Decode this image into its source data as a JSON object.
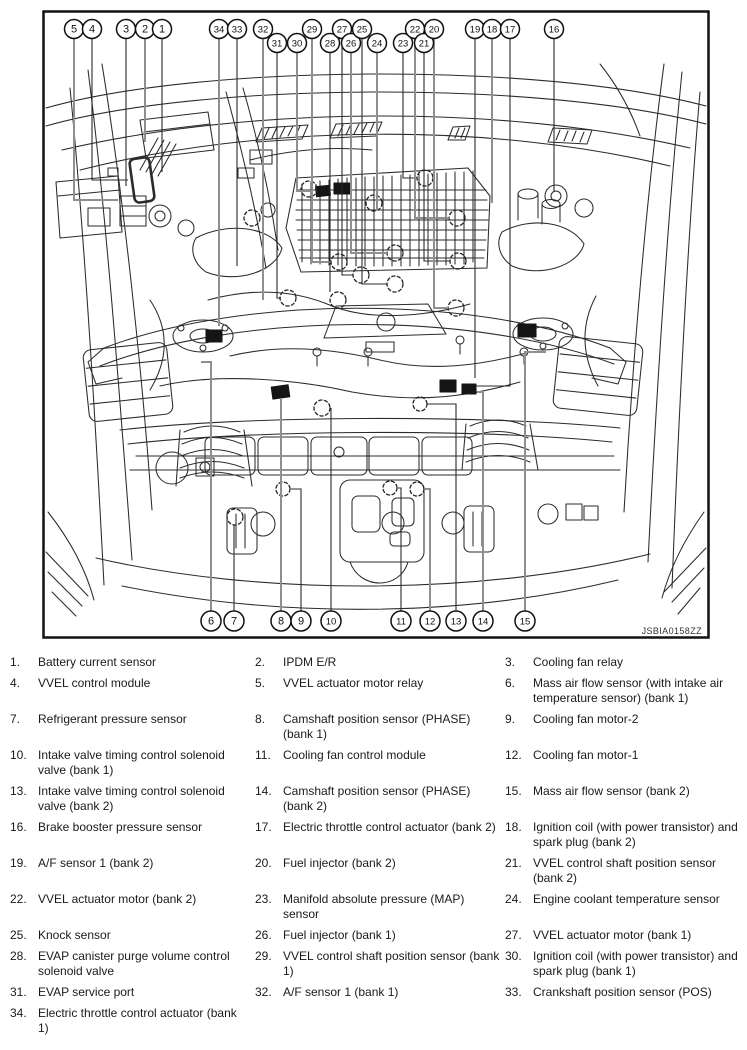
{
  "figure": {
    "code": "JSBIA0158ZZ",
    "callouts": [
      {
        "n": "5",
        "x": 74,
        "y": 29,
        "ey": 200,
        "jx": 118,
        "style": "gray"
      },
      {
        "n": "4",
        "x": 92,
        "y": 29,
        "ey": 180,
        "jx": 128,
        "style": "black"
      },
      {
        "n": "3",
        "x": 126,
        "y": 29,
        "ey": 186,
        "style": "black"
      },
      {
        "n": "2",
        "x": 145,
        "y": 29,
        "ey": 142,
        "style": "gray"
      },
      {
        "n": "1",
        "x": 162,
        "y": 29,
        "ey": 172,
        "style": "black"
      },
      {
        "n": "34",
        "x": 219,
        "y": 29,
        "ey": 326,
        "style": "gray"
      },
      {
        "n": "33",
        "x": 237,
        "y": 29,
        "ey": 266,
        "style": "black"
      },
      {
        "n": "32",
        "x": 263,
        "y": 29,
        "ey": 300,
        "style": "gray"
      },
      {
        "n": "31",
        "x": 277,
        "y": 43,
        "ey": 298,
        "jx": 281,
        "style": "black"
      },
      {
        "n": "30",
        "x": 297,
        "y": 43,
        "ey": 191,
        "jx": 312,
        "style": "gray"
      },
      {
        "n": "29",
        "x": 312,
        "y": 29,
        "ey": 262,
        "jx": 331,
        "style": "gray"
      },
      {
        "n": "28",
        "x": 330,
        "y": 43,
        "ey": 292,
        "style": "black"
      },
      {
        "n": "27",
        "x": 342,
        "y": 29,
        "ey": 275,
        "jx": 353,
        "style": "black"
      },
      {
        "n": "26",
        "x": 351,
        "y": 43,
        "ey": 253,
        "jx": 387,
        "style": "gray"
      },
      {
        "n": "25",
        "x": 362,
        "y": 29,
        "ey": 284,
        "jx": 387,
        "style": "black"
      },
      {
        "n": "24",
        "x": 377,
        "y": 43,
        "ey": 211,
        "style": "gray"
      },
      {
        "n": "23",
        "x": 403,
        "y": 43,
        "ey": 178,
        "jx": 417,
        "style": "black"
      },
      {
        "n": "22",
        "x": 415,
        "y": 29,
        "ey": 218,
        "jx": 449,
        "style": "gray"
      },
      {
        "n": "21",
        "x": 424,
        "y": 43,
        "ey": 261,
        "jx": 450,
        "style": "black"
      },
      {
        "n": "20",
        "x": 434,
        "y": 29,
        "ey": 308,
        "jx": 448,
        "style": "gray"
      },
      {
        "n": "19",
        "x": 475,
        "y": 29,
        "ey": 378,
        "style": "black"
      },
      {
        "n": "18",
        "x": 492,
        "y": 29,
        "ey": 203,
        "style": "gray"
      },
      {
        "n": "17",
        "x": 510,
        "y": 29,
        "ey": 386,
        "jx": 476,
        "style": "black"
      },
      {
        "n": "16",
        "x": 554,
        "y": 29,
        "ey": 192,
        "style": "black"
      },
      {
        "n": "6",
        "x": 211,
        "y": 621,
        "dir": "up",
        "ey": 362,
        "jx": 201,
        "style": "gray"
      },
      {
        "n": "7",
        "x": 234,
        "y": 621,
        "dir": "up",
        "ey": 525,
        "style": "black"
      },
      {
        "n": "8",
        "x": 281,
        "y": 621,
        "dir": "up",
        "ey": 398,
        "style": "gray"
      },
      {
        "n": "9",
        "x": 301,
        "y": 621,
        "dir": "up",
        "ey": 489,
        "jx": 291,
        "style": "black"
      },
      {
        "n": "10",
        "x": 331,
        "y": 621,
        "dir": "up",
        "ey": 408,
        "style": "black"
      },
      {
        "n": "11",
        "x": 401,
        "y": 621,
        "dir": "up",
        "ey": 488,
        "jx": 398,
        "style": "black"
      },
      {
        "n": "12",
        "x": 430,
        "y": 621,
        "dir": "up",
        "ey": 489,
        "jx": 425,
        "style": "gray"
      },
      {
        "n": "13",
        "x": 456,
        "y": 621,
        "dir": "up",
        "ey": 404,
        "jx": 427,
        "style": "black"
      },
      {
        "n": "14",
        "x": 483,
        "y": 621,
        "dir": "up",
        "ey": 392,
        "jx": 478,
        "style": "gray"
      },
      {
        "n": "15",
        "x": 525,
        "y": 621,
        "dir": "up",
        "ey": 352,
        "jx": 546,
        "style": "gray"
      }
    ]
  },
  "legend": {
    "items": [
      {
        "num": "1.",
        "label": "Battery current sensor"
      },
      {
        "num": "2.",
        "label": "IPDM E/R"
      },
      {
        "num": "3.",
        "label": "Cooling fan relay"
      },
      {
        "num": "4.",
        "label": "VVEL control module"
      },
      {
        "num": "5.",
        "label": "VVEL actuator motor relay"
      },
      {
        "num": "6.",
        "label": "Mass air flow sensor (with intake air temperature sensor) (bank 1)"
      },
      {
        "num": "7.",
        "label": "Refrigerant pressure sensor"
      },
      {
        "num": "8.",
        "label": "Camshaft position sensor (PHASE) (bank 1)"
      },
      {
        "num": "9.",
        "label": "Cooling fan motor-2"
      },
      {
        "num": "10.",
        "label": "Intake valve timing control solenoid valve (bank 1)"
      },
      {
        "num": "11.",
        "label": "Cooling fan control module"
      },
      {
        "num": "12.",
        "label": "Cooling fan motor-1"
      },
      {
        "num": "13.",
        "label": "Intake valve timing control solenoid valve (bank 2)"
      },
      {
        "num": "14.",
        "label": "Camshaft position sensor (PHASE) (bank 2)"
      },
      {
        "num": "15.",
        "label": "Mass air flow sensor (bank 2)"
      },
      {
        "num": "16.",
        "label": "Brake booster pressure sensor"
      },
      {
        "num": "17.",
        "label": "Electric throttle control actuator (bank 2)"
      },
      {
        "num": "18.",
        "label": "Ignition coil (with power transistor) and spark plug (bank 2)"
      },
      {
        "num": "19.",
        "label": "A/F sensor 1 (bank 2)"
      },
      {
        "num": "20.",
        "label": "Fuel injector (bank 2)"
      },
      {
        "num": "21.",
        "label": "VVEL control shaft position sensor (bank 2)"
      },
      {
        "num": "22.",
        "label": "VVEL actuator motor (bank 2)"
      },
      {
        "num": "23.",
        "label": "Manifold absolute pressure (MAP) sensor"
      },
      {
        "num": "24.",
        "label": "Engine coolant temperature sensor"
      },
      {
        "num": "25.",
        "label": "Knock sensor"
      },
      {
        "num": "26.",
        "label": "Fuel injector (bank 1)"
      },
      {
        "num": "27.",
        "label": "VVEL actuator motor (bank 1)"
      },
      {
        "num": "28.",
        "label": "EVAP canister purge volume control solenoid valve"
      },
      {
        "num": "29.",
        "label": "VVEL control shaft position sensor (bank 1)"
      },
      {
        "num": "30.",
        "label": "Ignition coil (with power transistor) and spark plug (bank 1)"
      },
      {
        "num": "31.",
        "label": "EVAP service port"
      },
      {
        "num": "32.",
        "label": "A/F sensor 1 (bank 1)"
      },
      {
        "num": "33.",
        "label": "Crankshaft position sensor (POS)"
      },
      {
        "num": "34.",
        "label": "Electric throttle control actuator (bank 1)"
      }
    ]
  }
}
